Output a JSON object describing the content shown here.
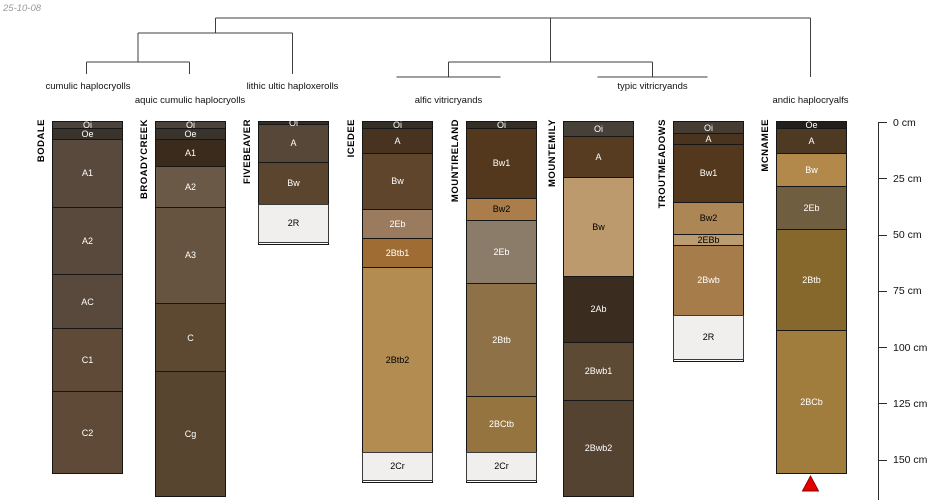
{
  "stamp": "25-10-08",
  "depth_axis": {
    "unit": "cm",
    "ticks": [
      {
        "label": "0 cm",
        "cm": 0
      },
      {
        "label": "25 cm",
        "cm": 25
      },
      {
        "label": "50 cm",
        "cm": 50
      },
      {
        "label": "75 cm",
        "cm": 75
      },
      {
        "label": "100 cm",
        "cm": 100
      },
      {
        "label": "125 cm",
        "cm": 125
      },
      {
        "label": "150 cm",
        "cm": 150
      }
    ]
  },
  "chart_data": {
    "type": "soil-profile-dendrogram",
    "ylabel": "depth (cm)",
    "ylim": [
      0,
      167
    ],
    "groups": [
      {
        "label": "cumulic haplocryolls",
        "x": 88,
        "y": 81
      },
      {
        "label": "aquic cumulic haplocryolls",
        "x": 190,
        "y": 95
      },
      {
        "label": "lithic ultic haploxerolls",
        "x": 292.5,
        "y": 81
      },
      {
        "label": "alfic vitricryands",
        "x": 448.5,
        "y": 95
      },
      {
        "label": "typic vitricryands",
        "x": 652.5,
        "y": 81
      },
      {
        "label": "andic haplocryalfs",
        "x": 810.5,
        "y": 95
      }
    ],
    "dendrogram": {
      "line_color": "#3f3f3f",
      "segments": [
        [
          215.25,
          18,
          810.5,
          18
        ],
        [
          215.25,
          18,
          215.25,
          33
        ],
        [
          138,
          33,
          292.5,
          33
        ],
        [
          138,
          33,
          138,
          62
        ],
        [
          86.5,
          62,
          189.5,
          62
        ],
        [
          86.5,
          62,
          86.5,
          74
        ],
        [
          189.5,
          62,
          189.5,
          74
        ],
        [
          292.5,
          33,
          292.5,
          74
        ],
        [
          550.5,
          18,
          550.5,
          62
        ],
        [
          448.5,
          62,
          652.5,
          62
        ],
        [
          448.5,
          62,
          448.5,
          77
        ],
        [
          396.5,
          77,
          500.5,
          77
        ],
        [
          652.5,
          62,
          652.5,
          77
        ],
        [
          597.5,
          77,
          707.5,
          77
        ],
        [
          810.5,
          18,
          810.5,
          77
        ]
      ]
    },
    "profiles": [
      {
        "id": "BODALE",
        "group": "cumulic haplocryolls",
        "x_center": 86.5,
        "horizons": [
          {
            "name": "Oi",
            "top": 0,
            "bottom": 3,
            "color": "#4b433b",
            "text": "#ffffff"
          },
          {
            "name": "Oe",
            "top": 3,
            "bottom": 8,
            "color": "#3a332b",
            "text": "#ffffff"
          },
          {
            "name": "A1",
            "top": 8,
            "bottom": 38,
            "color": "#59493c",
            "text": "#ffffff"
          },
          {
            "name": "A2",
            "top": 38,
            "bottom": 68,
            "color": "#59493c",
            "text": "#ffffff"
          },
          {
            "name": "AC",
            "top": 68,
            "bottom": 92,
            "color": "#59493c",
            "text": "#ffffff"
          },
          {
            "name": "C1",
            "top": 92,
            "bottom": 120,
            "color": "#5e4a36",
            "text": "#ffffff"
          },
          {
            "name": "C2",
            "top": 120,
            "bottom": 156,
            "color": "#5e4a36",
            "text": "#ffffff"
          }
        ]
      },
      {
        "id": "BROADYCREEK",
        "group": "aquic cumulic haplocryolls",
        "x_center": 189.5,
        "horizons": [
          {
            "name": "Oi",
            "top": 0,
            "bottom": 3,
            "color": "#4b433b",
            "text": "#ffffff"
          },
          {
            "name": "Oe",
            "top": 3,
            "bottom": 8,
            "color": "#3a332b",
            "text": "#ffffff"
          },
          {
            "name": "A1",
            "top": 8,
            "bottom": 20,
            "color": "#3a2b1c",
            "text": "#ffffff"
          },
          {
            "name": "A2",
            "top": 20,
            "bottom": 38,
            "color": "#6b5947",
            "text": "#ffffff"
          },
          {
            "name": "A3",
            "top": 38,
            "bottom": 81,
            "color": "#665441",
            "text": "#ffffff"
          },
          {
            "name": "C",
            "top": 81,
            "bottom": 111,
            "color": "#5d4932",
            "text": "#ffffff"
          },
          {
            "name": "Cg",
            "top": 111,
            "bottom": 166,
            "color": "#57452f",
            "text": "#ffffff"
          }
        ]
      },
      {
        "id": "FIVEBEAVER",
        "group": "lithic ultic haploxerolls",
        "x_center": 292.5,
        "horizons": [
          {
            "name": "Oi",
            "top": 0,
            "bottom": 1.5,
            "color": "#352e26",
            "text": "#ffffff"
          },
          {
            "name": "A",
            "top": 1.5,
            "bottom": 18,
            "color": "#574738",
            "text": "#ffffff"
          },
          {
            "name": "Bw",
            "top": 18,
            "bottom": 37,
            "color": "#5b452e",
            "text": "#ffffff"
          },
          {
            "name": "2R",
            "top": 37,
            "bottom": 54,
            "color": "#f0efed",
            "text": "#000000",
            "rock": true
          }
        ]
      },
      {
        "id": "ICEDEE",
        "group": "alfic vitricryands",
        "x_center": 396.5,
        "horizons": [
          {
            "name": "Oi",
            "top": 0,
            "bottom": 3,
            "color": "#352e26",
            "text": "#ffffff"
          },
          {
            "name": "A",
            "top": 3,
            "bottom": 14,
            "color": "#47331f",
            "text": "#ffffff"
          },
          {
            "name": "Bw",
            "top": 14,
            "bottom": 39,
            "color": "#5f452c",
            "text": "#ffffff"
          },
          {
            "name": "2Eb",
            "top": 39,
            "bottom": 52,
            "color": "#9b7b5e",
            "text": "#ffffff"
          },
          {
            "name": "2Btb1",
            "top": 52,
            "bottom": 65,
            "color": "#9f6c33",
            "text": "#ffffff"
          },
          {
            "name": "2Btb2",
            "top": 65,
            "bottom": 147,
            "color": "#b28c50",
            "text": "#000000"
          },
          {
            "name": "2Cr",
            "top": 147,
            "bottom": 160,
            "color": "#f0efed",
            "text": "#000000",
            "rock": true
          }
        ]
      },
      {
        "id": "MOUNTIRELAND",
        "group": "alfic vitricryands",
        "x_center": 500.5,
        "horizons": [
          {
            "name": "Oi",
            "top": 0,
            "bottom": 3,
            "color": "#352e26",
            "text": "#ffffff"
          },
          {
            "name": "Bw1",
            "top": 3,
            "bottom": 34,
            "color": "#54381d",
            "text": "#ffffff"
          },
          {
            "name": "Bw2",
            "top": 34,
            "bottom": 44,
            "color": "#aa7d4a",
            "text": "#000000"
          },
          {
            "name": "2Eb",
            "top": 44,
            "bottom": 72,
            "color": "#8b7c69",
            "text": "#ffffff"
          },
          {
            "name": "2Btb",
            "top": 72,
            "bottom": 122,
            "color": "#8f7147",
            "text": "#ffffff"
          },
          {
            "name": "2BCtb",
            "top": 122,
            "bottom": 147,
            "color": "#95743f",
            "text": "#ffffff"
          },
          {
            "name": "2Cr",
            "top": 147,
            "bottom": 160,
            "color": "#f0efed",
            "text": "#000000",
            "rock": true
          }
        ]
      },
      {
        "id": "MOUNTEMILY",
        "group": "typic vitricryands",
        "x_center": 597.5,
        "horizons": [
          {
            "name": "Oi",
            "top": 0,
            "bottom": 6.5,
            "color": "#474039",
            "text": "#ffffff"
          },
          {
            "name": "A",
            "top": 6.5,
            "bottom": 25,
            "color": "#573c22",
            "text": "#ffffff"
          },
          {
            "name": "Bw",
            "top": 25,
            "bottom": 69,
            "color": "#bd9a6d",
            "text": "#000000"
          },
          {
            "name": "2Ab",
            "top": 69,
            "bottom": 98,
            "color": "#3a2c1e",
            "text": "#ffffff"
          },
          {
            "name": "2Bwb1",
            "top": 98,
            "bottom": 124,
            "color": "#5d4a34",
            "text": "#ffffff"
          },
          {
            "name": "2Bwb2",
            "top": 124,
            "bottom": 166,
            "color": "#544330",
            "text": "#ffffff"
          }
        ]
      },
      {
        "id": "TROUTMEADOWS",
        "group": "typic vitricryands",
        "x_center": 707.5,
        "horizons": [
          {
            "name": "Oi",
            "top": 0,
            "bottom": 5.5,
            "color": "#453d33",
            "text": "#ffffff"
          },
          {
            "name": "A",
            "top": 5.5,
            "bottom": 10,
            "color": "#4a3420",
            "text": "#ffffff"
          },
          {
            "name": "Bw1",
            "top": 10,
            "bottom": 36,
            "color": "#54381d",
            "text": "#ffffff"
          },
          {
            "name": "Bw2",
            "top": 36,
            "bottom": 50,
            "color": "#ad8655",
            "text": "#000000"
          },
          {
            "name": "2EBb",
            "top": 50,
            "bottom": 55,
            "color": "#bb9c70",
            "text": "#000000"
          },
          {
            "name": "2Bwb",
            "top": 55,
            "bottom": 86,
            "color": "#a67d4a",
            "text": "#ffffff"
          },
          {
            "name": "2R",
            "top": 86,
            "bottom": 106,
            "color": "#f0efed",
            "text": "#000000",
            "rock": true
          }
        ]
      },
      {
        "id": "MCNAMEE",
        "group": "andic haplocryalfs",
        "x_center": 810.5,
        "marker": {
          "shape": "triangle-up",
          "color": "#e60000"
        },
        "horizons": [
          {
            "name": "Oe",
            "top": 0,
            "bottom": 3,
            "color": "#231f1a",
            "text": "#ffffff"
          },
          {
            "name": "A",
            "top": 3,
            "bottom": 14,
            "color": "#4e3a23",
            "text": "#ffffff"
          },
          {
            "name": "Bw",
            "top": 14,
            "bottom": 29,
            "color": "#b2894a",
            "text": "#ffffff"
          },
          {
            "name": "2Eb",
            "top": 29,
            "bottom": 48,
            "color": "#705e40",
            "text": "#ffffff"
          },
          {
            "name": "2Btb",
            "top": 48,
            "bottom": 93,
            "color": "#87682c",
            "text": "#ffffff"
          },
          {
            "name": "2BCb",
            "top": 93,
            "bottom": 156,
            "color": "#a07c3d",
            "text": "#ffffff"
          }
        ]
      }
    ]
  }
}
